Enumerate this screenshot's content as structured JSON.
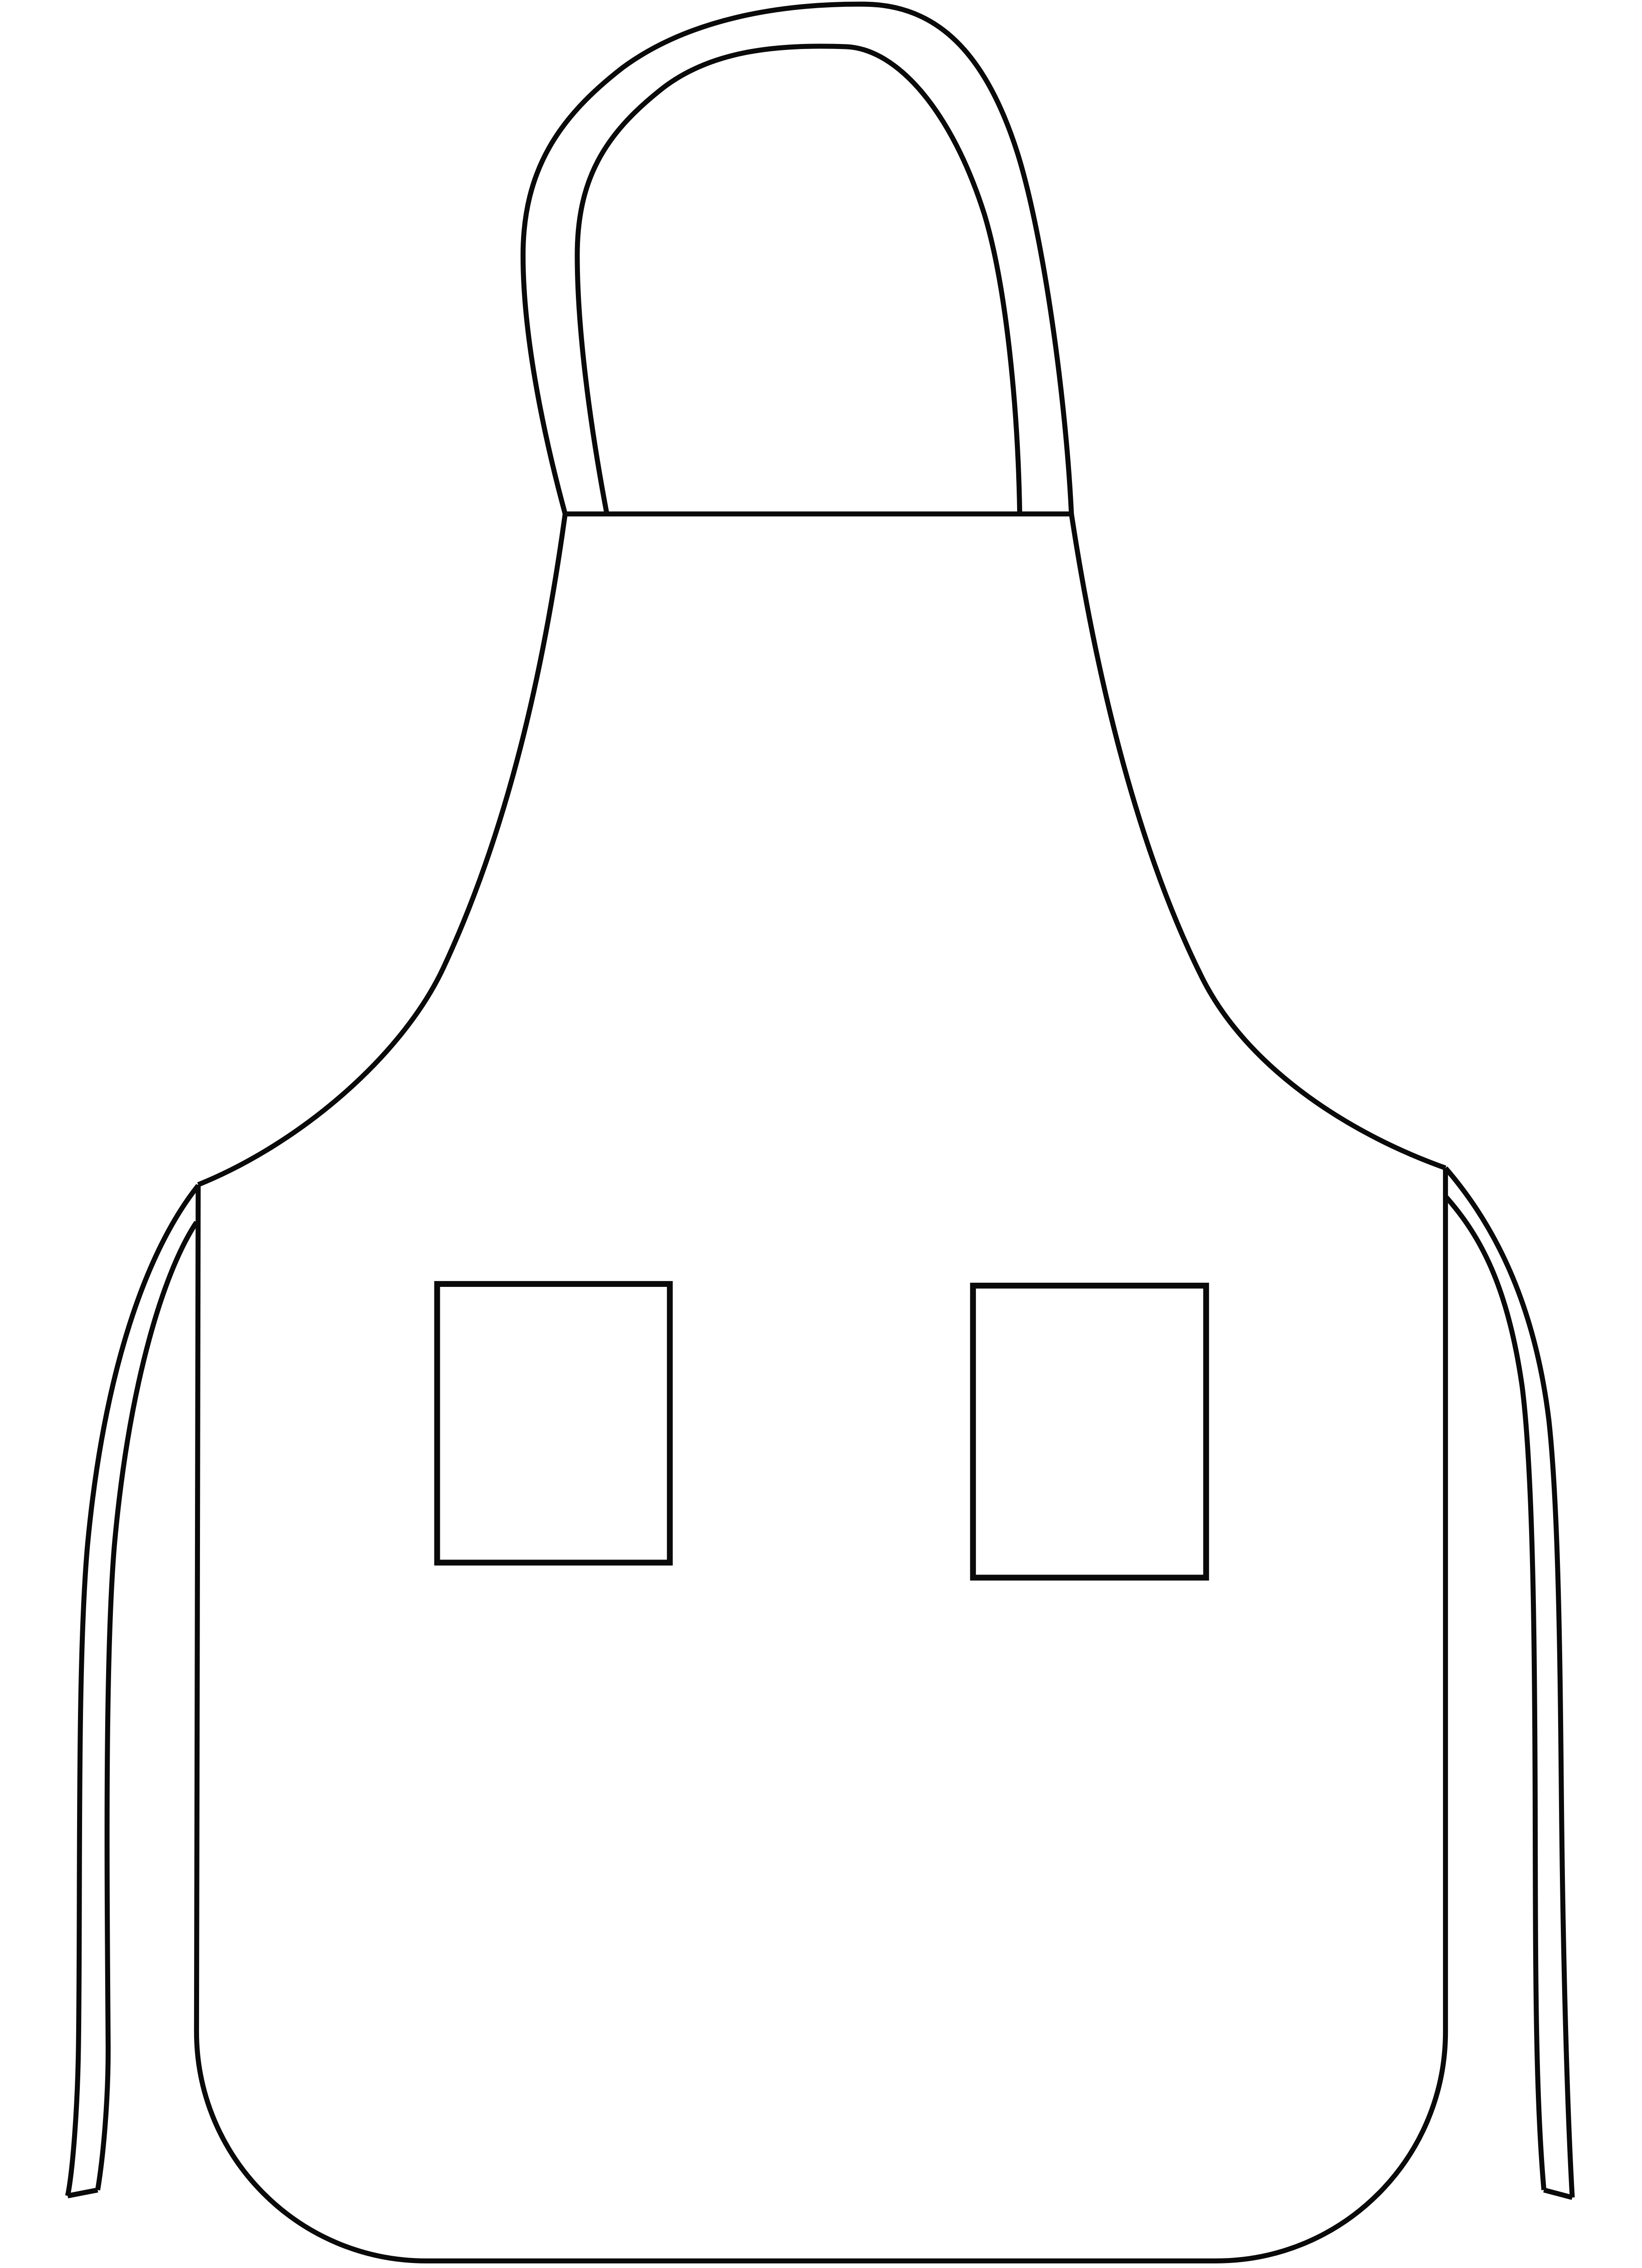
{
  "artwork": {
    "subject": "apron",
    "description": "Black and white outline drawing of a bib apron with a looped neck strap, two waist ties and two square front pockets",
    "style": "line-art clip art",
    "line_color": "#0a0a0a",
    "background_color": "#ffffff",
    "parts": {
      "neck_strap": "neck strap loop",
      "bib": "bib",
      "body": "apron body",
      "left_tie": "left waist tie",
      "right_tie": "right waist tie",
      "left_pocket": "left pocket",
      "right_pocket": "right pocket"
    }
  }
}
